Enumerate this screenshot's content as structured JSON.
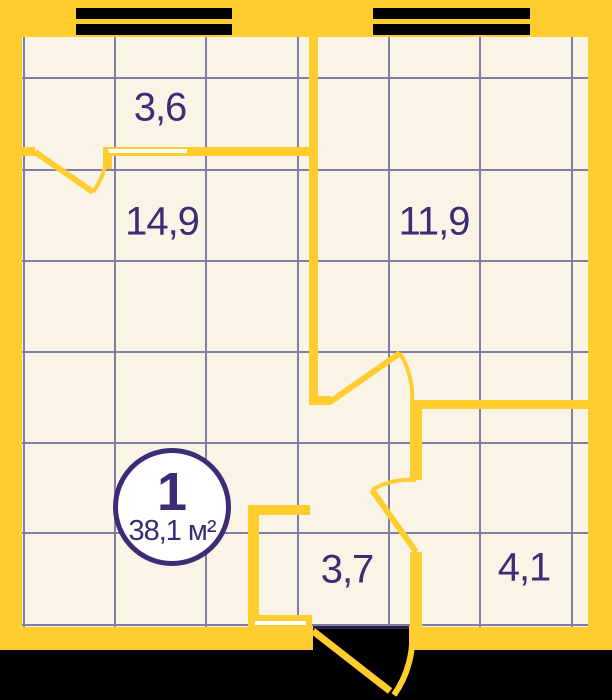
{
  "colors": {
    "wall": "#FFCE2E",
    "floor": "#FAF4E7",
    "grid": "#837CA8",
    "ink": "#3D2C75",
    "outside": "#000000",
    "opening": "#FFFFFF",
    "threshold": "#2B2144"
  },
  "badge": {
    "number": "1",
    "area": "38,1 м²"
  },
  "rooms": [
    {
      "area_label": "3,6"
    },
    {
      "area_label": "14,9"
    },
    {
      "area_label": "11,9"
    },
    {
      "area_label": "3,7"
    },
    {
      "area_label": "4,1"
    }
  ]
}
